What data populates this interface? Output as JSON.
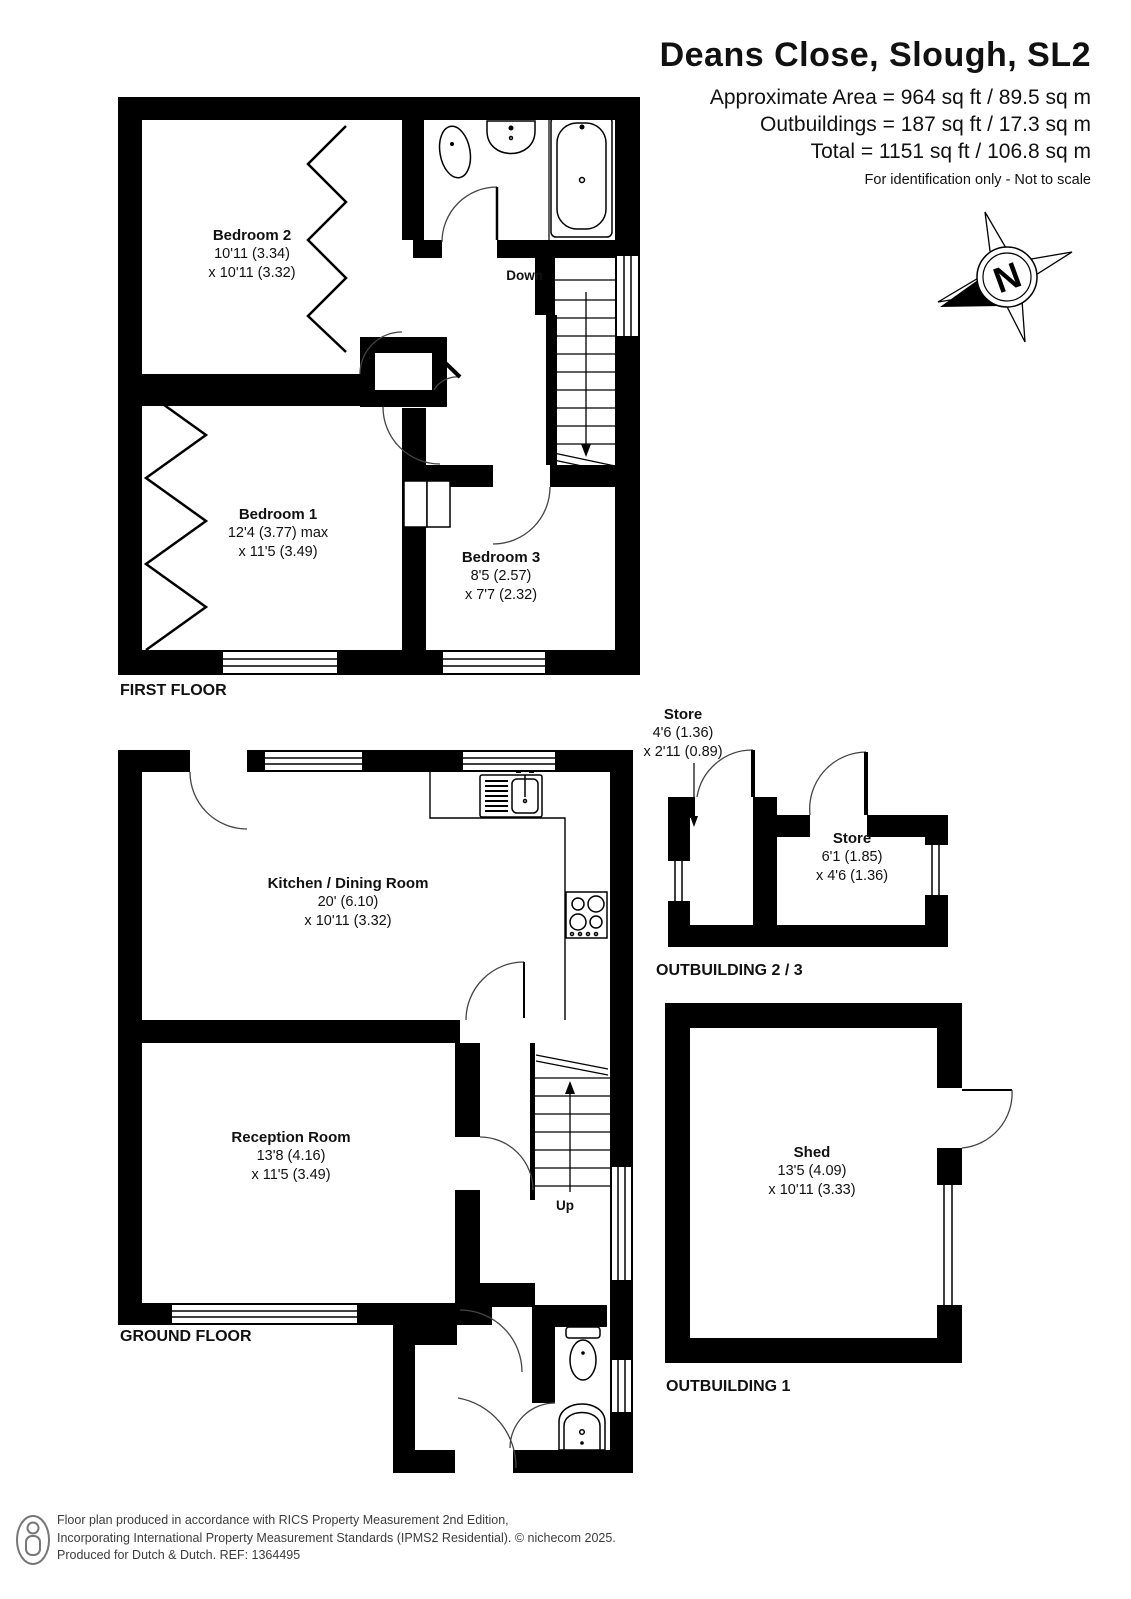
{
  "header": {
    "title": "Deans Close, Slough, SL2",
    "area_line1": "Approximate Area = 964 sq ft / 89.5 sq m",
    "area_line2": "Outbuildings = 187 sq ft / 17.3 sq m",
    "area_line3": "Total = 1151 sq ft / 106.8 sq m",
    "disclaimer": "For identification only - Not to scale"
  },
  "compass": {
    "letter": "N"
  },
  "floors": {
    "first": "FIRST FLOOR",
    "ground": "GROUND FLOOR",
    "outbuilding23": "OUTBUILDING 2 / 3",
    "outbuilding1": "OUTBUILDING 1"
  },
  "rooms": {
    "bedroom2": {
      "name": "Bedroom 2",
      "dim1": "10'11 (3.34)",
      "dim2": "x 10'11 (3.32)"
    },
    "bedroom1": {
      "name": "Bedroom 1",
      "dim1": "12'4 (3.77) max",
      "dim2": "x 11'5 (3.49)"
    },
    "bedroom3": {
      "name": "Bedroom 3",
      "dim1": "8'5 (2.57)",
      "dim2": "x 7'7 (2.32)"
    },
    "kitchen": {
      "name": "Kitchen / Dining Room",
      "dim1": "20' (6.10)",
      "dim2": "x 10'11 (3.32)"
    },
    "reception": {
      "name": "Reception Room",
      "dim1": "13'8 (4.16)",
      "dim2": "x 11'5 (3.49)"
    },
    "store_small": {
      "name": "Store",
      "dim1": "4'6 (1.36)",
      "dim2": "x 2'11 (0.89)"
    },
    "store_large": {
      "name": "Store",
      "dim1": "6'1 (1.85)",
      "dim2": "x 4'6 (1.36)"
    },
    "shed": {
      "name": "Shed",
      "dim1": "13'5 (4.09)",
      "dim2": "x 10'11 (3.33)"
    }
  },
  "stairs": {
    "down": "Down",
    "up": "Up"
  },
  "footer": {
    "line1": "Floor plan produced in accordance with RICS Property Measurement 2nd Edition,",
    "line2": "Incorporating International Property Measurement Standards (IPMS2 Residential).   © nichecom 2025.",
    "line3": "Produced for Dutch & Dutch.   REF:  1364495"
  },
  "colors": {
    "wall": "#000000",
    "footer_text": "#3c3c3c"
  }
}
